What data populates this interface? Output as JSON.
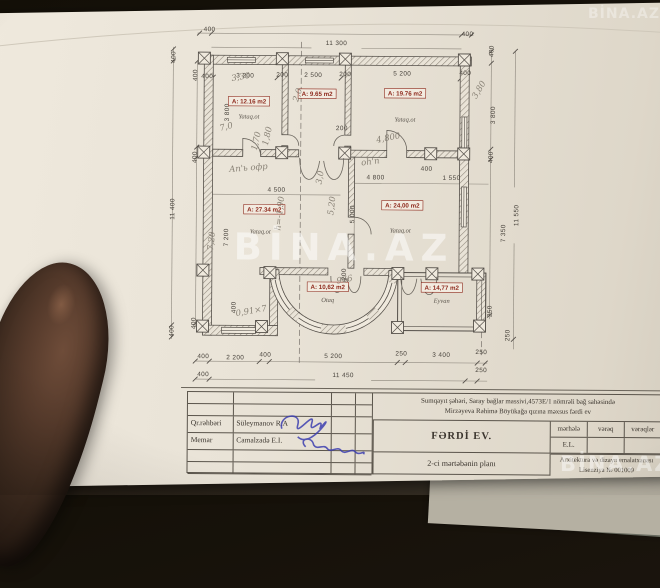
{
  "colors": {
    "paper": "#e9e3d7",
    "ink": "#46413a",
    "wall-line": "#55504a",
    "room-red": "#8f2b1e",
    "pencil": "#8b8375",
    "sign-blue": "#3d3fb0",
    "photo-bg": "#17120e",
    "under-sheet": "#7d8073"
  },
  "watermark": {
    "center": "BİNA.AZ",
    "bottom_right": "BİNA.AZ",
    "top_right": "BİNA.AZ"
  },
  "plan": {
    "labels": [
      [
        "400",
        60,
        14,
        0,
        "d"
      ],
      [
        "11 300",
        187,
        27,
        0,
        "d"
      ],
      [
        "400",
        318,
        17,
        0,
        "d"
      ],
      [
        "400",
        58,
        61,
        0,
        "d"
      ],
      [
        "3 200",
        96,
        60,
        0,
        "d"
      ],
      [
        "200",
        133,
        59,
        0,
        "d"
      ],
      [
        "2 500",
        164,
        59,
        0,
        "d"
      ],
      [
        "200",
        196,
        58,
        0,
        "d"
      ],
      [
        "5 200",
        253,
        57,
        0,
        "d"
      ],
      [
        "400",
        316,
        56,
        0,
        "d"
      ],
      [
        "400",
        26,
        40,
        -90,
        "d"
      ],
      [
        "11 400",
        26,
        192,
        -90,
        "d"
      ],
      [
        "400",
        26,
        314,
        -90,
        "d"
      ],
      [
        "400",
        48,
        58,
        -90,
        "d"
      ],
      [
        "3 800",
        80,
        95,
        -90,
        "d"
      ],
      [
        "400",
        48,
        140,
        -90,
        "d"
      ],
      [
        "7 200",
        80,
        220,
        -90,
        "d"
      ],
      [
        "400",
        48,
        306,
        -90,
        "d"
      ],
      [
        "400",
        344,
        32,
        -90,
        "d"
      ],
      [
        "3 800",
        346,
        96,
        -90,
        "d"
      ],
      [
        "400",
        344,
        138,
        -90,
        "d"
      ],
      [
        "7 350",
        357,
        214,
        -90,
        "d"
      ],
      [
        "250",
        344,
        292,
        -90,
        "d"
      ],
      [
        "11 550",
        370,
        196,
        -90,
        "d"
      ],
      [
        "250",
        362,
        316,
        -90,
        "d"
      ],
      [
        "4 500",
        128,
        174,
        0,
        "d"
      ],
      [
        "4 800",
        227,
        161,
        0,
        "d"
      ],
      [
        "1 550",
        303,
        161,
        0,
        "d"
      ],
      [
        "200",
        193,
        112,
        0,
        "d"
      ],
      [
        "5 000",
        206,
        196,
        -90,
        "d"
      ],
      [
        "400",
        278,
        152,
        0,
        "d"
      ],
      [
        "200",
        198,
        256,
        -90,
        "d"
      ],
      [
        "400",
        88,
        290,
        -90,
        "d"
      ],
      [
        "400",
        56,
        341,
        0,
        "d"
      ],
      [
        "2 200",
        88,
        342,
        0,
        "d"
      ],
      [
        "400",
        118,
        339,
        0,
        "d"
      ],
      [
        "5 200",
        186,
        340,
        0,
        "d"
      ],
      [
        "250",
        254,
        337,
        0,
        "d"
      ],
      [
        "3 400",
        294,
        338,
        0,
        "d"
      ],
      [
        "250",
        334,
        335,
        0,
        "d"
      ],
      [
        "400",
        56,
        359,
        0,
        "d"
      ],
      [
        "11 450",
        196,
        359,
        0,
        "d"
      ],
      [
        "250",
        334,
        353,
        0,
        "d"
      ],
      [
        "A: 12.16 m2",
        100,
        86,
        0,
        "r"
      ],
      [
        "A: 9.65 m2",
        168,
        78,
        0,
        "r"
      ],
      [
        "A: 19.76 m2",
        256,
        77,
        0,
        "r"
      ],
      [
        "A: 27.34 m2",
        116,
        194,
        0,
        "r"
      ],
      [
        "A: 24,00 m2",
        254,
        189,
        0,
        "r"
      ],
      [
        "A: 10,62 m2",
        180,
        271,
        0,
        "r"
      ],
      [
        "A: 14,77 m2",
        294,
        271,
        0,
        "r"
      ],
      [
        "Yataq.ot",
        100,
        101,
        0,
        "s"
      ],
      [
        "Yataq.ot",
        256,
        103,
        0,
        "s"
      ],
      [
        "Yataq.ot",
        112,
        216,
        0,
        "s"
      ],
      [
        "Yataq.ot",
        252,
        214,
        0,
        "s"
      ],
      [
        "Otaq",
        180,
        284,
        0,
        "s"
      ],
      [
        "Eyvan",
        294,
        284,
        0,
        "s"
      ],
      [
        "3,30",
        92,
        62,
        -10,
        "h"
      ],
      [
        "2,0",
        151,
        78,
        -72,
        "h"
      ],
      [
        "3,80",
        332,
        72,
        -60,
        "h"
      ],
      [
        "1,70",
        110,
        124,
        -78,
        "h"
      ],
      [
        "1,80",
        121,
        119,
        -78,
        "h"
      ],
      [
        "7,0",
        78,
        112,
        -15,
        "h"
      ],
      [
        "4,800",
        240,
        122,
        -12,
        "h"
      ],
      [
        "oh'n",
        222,
        146,
        -8,
        "h"
      ],
      [
        "Aп'ь офр",
        100,
        153,
        -5,
        "h"
      ],
      [
        "h=-1,90",
        134,
        196,
        -84,
        "h"
      ],
      [
        "5,20",
        186,
        188,
        -84,
        "h"
      ],
      [
        "3,0",
        174,
        160,
        -80,
        "h"
      ],
      [
        "7,20",
        66,
        224,
        -84,
        "h"
      ],
      [
        "0,91×7",
        104,
        296,
        -10,
        "h"
      ],
      [
        "996",
        196,
        258,
        168,
        "h"
      ]
    ]
  },
  "title_block": {
    "site_line1": "Sumqayıt şəhəri, Saray bağlar massivi,4573E/1  nömrəli bağ sahəsində",
    "site_line2": "Mirzəyeva Rəhimə Böyükağa qızına məxsus fərdi ev",
    "project": "FƏRDİ EV.",
    "sheet": "2-ci mərtəbənin planı",
    "studio_line1": "Arxitektura və dizayn emalatxanası",
    "studio_line2": "Lisenziya № 001009",
    "cols": {
      "stage": "mərhələ",
      "sheet": "vərəq",
      "sheets": "vərəqlər"
    },
    "stage_value": "E.L.",
    "roles": [
      {
        "role": "Qr.rəhbəri",
        "name": "Süleymanov R.A"
      },
      {
        "role": "Memar",
        "name": "Camalzadə E.I."
      }
    ]
  }
}
